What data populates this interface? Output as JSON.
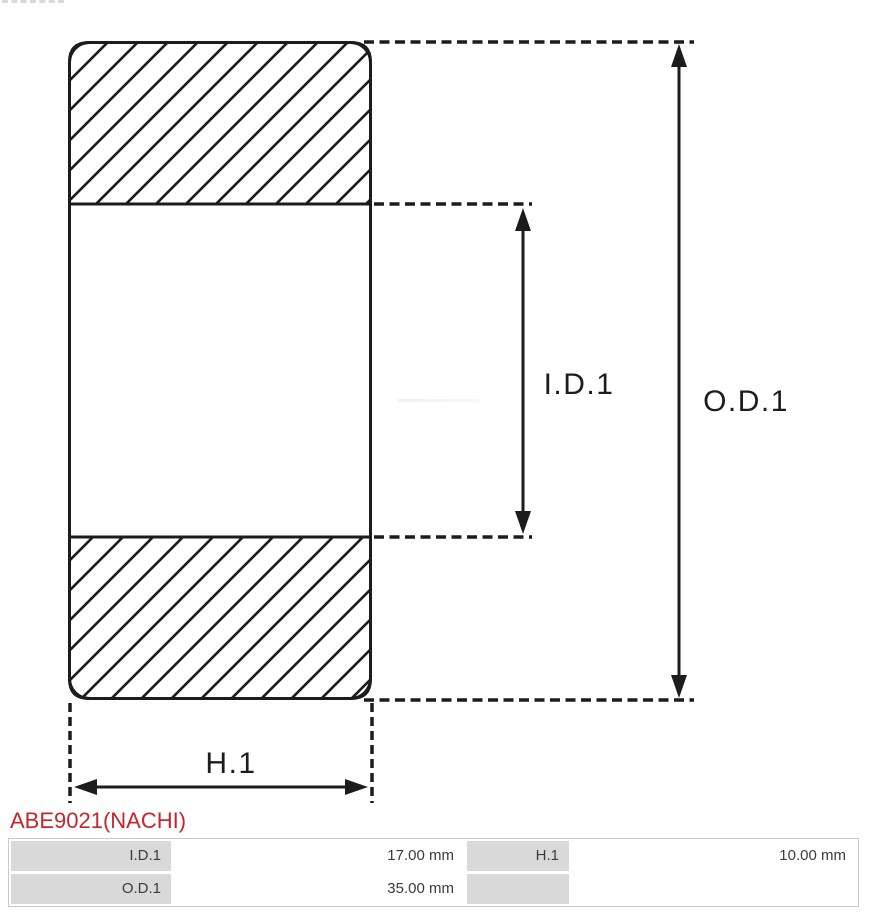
{
  "part_number": {
    "text": "ABE9021(NACHI)",
    "color": "#c5262c"
  },
  "diagram": {
    "type": "bearing-cross-section",
    "line_color": "#1c1c1c",
    "labels": {
      "inner_diameter": "I.D.1",
      "outer_diameter": "O.D.1",
      "width": "H.1"
    }
  },
  "spec_table": {
    "label_background": "#d9d9d9",
    "rows": [
      [
        "I.D.1",
        "17.00 mm",
        "H.1",
        "10.00 mm"
      ],
      [
        "O.D.1",
        "35.00 mm",
        "",
        ""
      ]
    ]
  }
}
